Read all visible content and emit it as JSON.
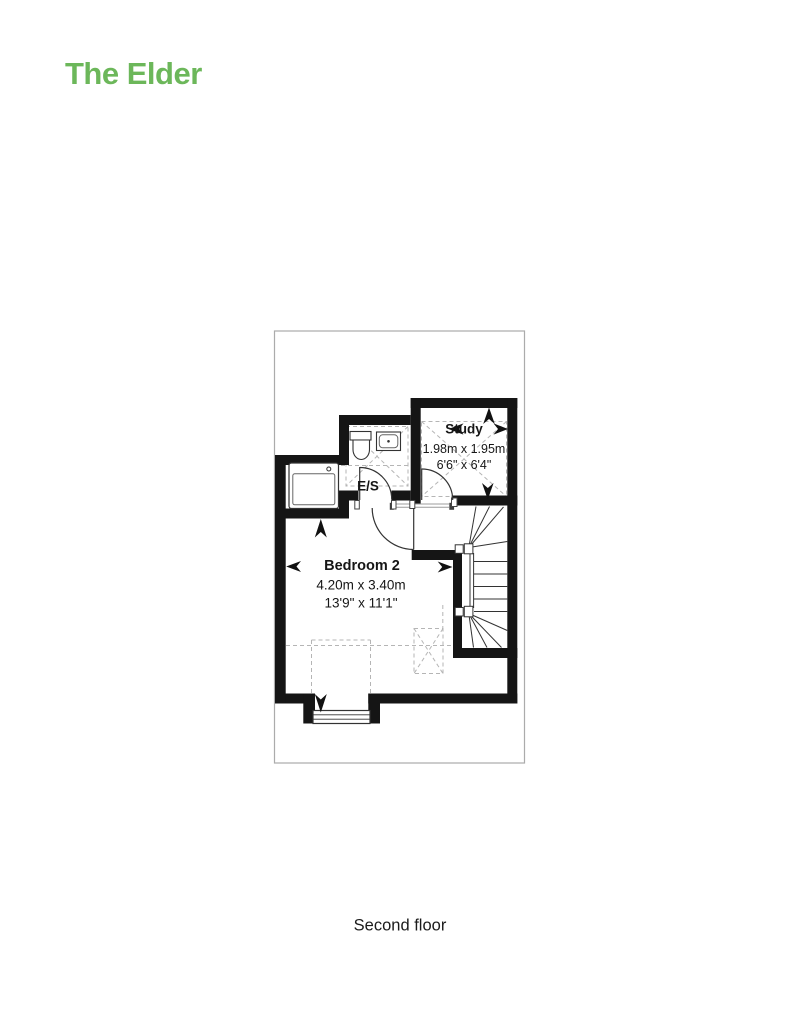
{
  "header": {
    "title": "The Elder",
    "accent_color": "#6cb75a"
  },
  "plan": {
    "rooms": {
      "study": {
        "name": "Study",
        "dimensions_metric": "1.98m x 1.95m",
        "dimensions_imperial": "6'6\" x 6'4\""
      },
      "ensuite": {
        "name": "E/S"
      },
      "bedroom2": {
        "name": "Bedroom 2",
        "dimensions_metric": "4.20m x 3.40m",
        "dimensions_imperial": "13'9\" x 11'1\""
      }
    },
    "fixtures": [
      "bath",
      "toilet",
      "basin",
      "winder-staircase",
      "dormer-window",
      "rooflight"
    ],
    "wall_color": "#151515",
    "boundary_color": "#ababab"
  },
  "footer": {
    "floor_label": "Second floor"
  }
}
